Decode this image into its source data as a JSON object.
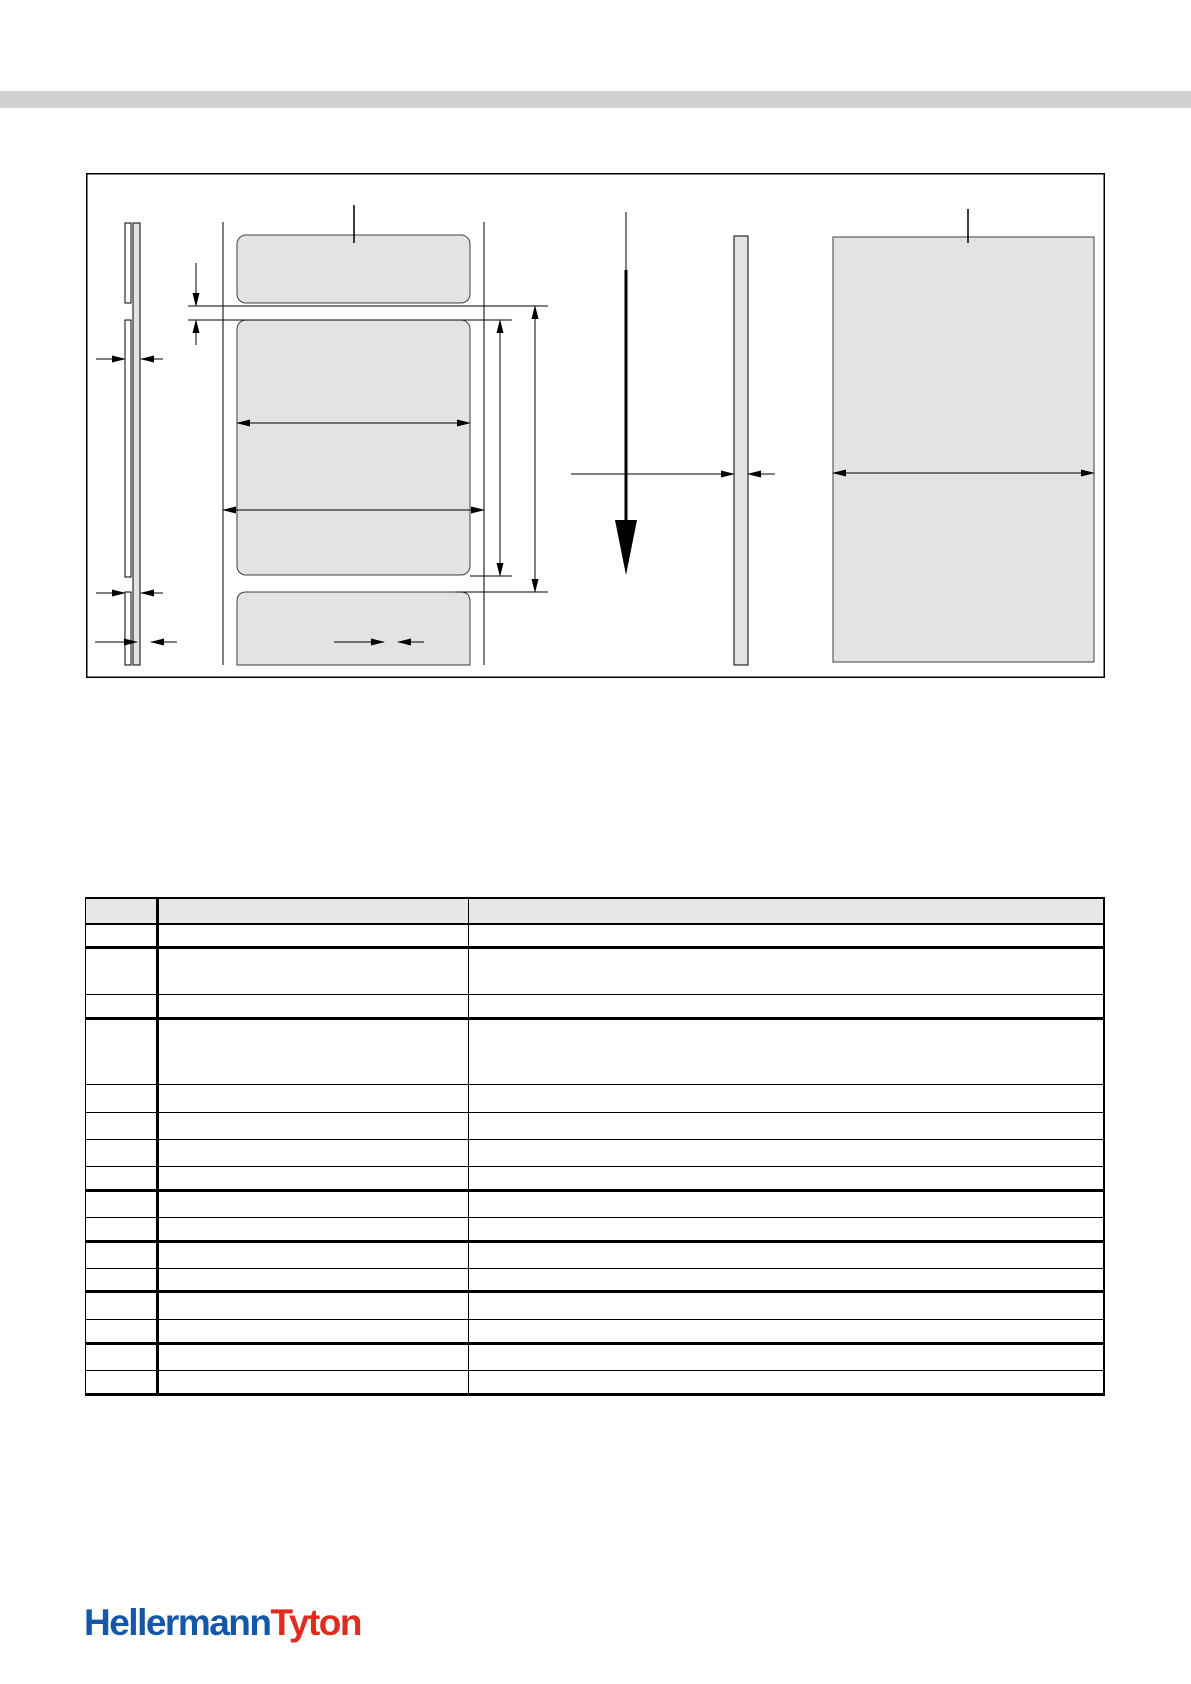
{
  "top_band": {
    "color": "#d1d1d3"
  },
  "diagram": {
    "name": "label-roll-dimension-drawing",
    "fill_color": "#e3e3e3",
    "line_color": "#000000",
    "parts": [
      "label-edge-view-strips",
      "thickness-dimension-arrows",
      "label-roll-front-view",
      "label-gap-dimension",
      "label-width-dimension",
      "liner-width-dimension",
      "label-length-dimension",
      "label-pitch-dimension",
      "margin-dimensions",
      "feed-direction-arrow",
      "liner-side-view-strip",
      "liner-thickness-dimension",
      "label-panel-view",
      "panel-width-dimension",
      "callout-lines"
    ]
  },
  "table": {
    "header_bg": "#e7e7e9",
    "header": [
      "",
      "",
      ""
    ],
    "rows": [
      [
        "",
        "",
        ""
      ],
      [
        "",
        "",
        ""
      ],
      [
        "",
        "",
        ""
      ],
      [
        "",
        "",
        ""
      ],
      [
        "",
        "",
        ""
      ],
      [
        "",
        "",
        ""
      ],
      [
        "",
        "",
        ""
      ],
      [
        "",
        "",
        ""
      ],
      [
        "",
        "",
        ""
      ],
      [
        "",
        "",
        ""
      ],
      [
        "",
        "",
        ""
      ],
      [
        "",
        "",
        ""
      ],
      [
        "",
        "",
        ""
      ],
      [
        "",
        "",
        ""
      ],
      [
        "",
        "",
        ""
      ],
      [
        "",
        "",
        ""
      ]
    ]
  },
  "logo": {
    "part1": "Hellermann",
    "part2": "Tyton",
    "part1_color": "#1457a8",
    "part2_color": "#e02b20"
  }
}
